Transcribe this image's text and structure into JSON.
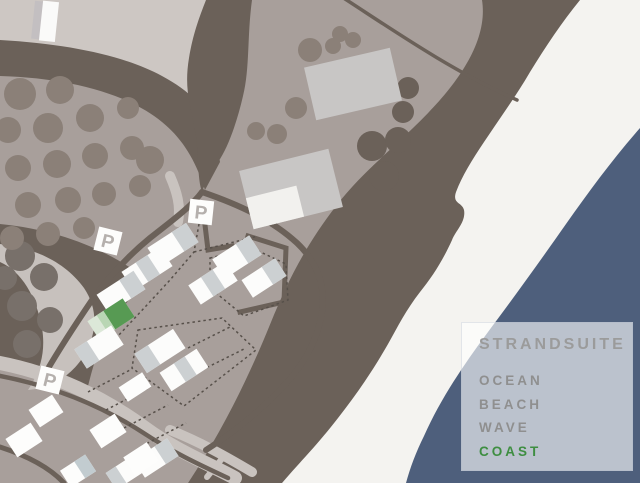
{
  "legend": {
    "title": "STRANDSUITE",
    "items": [
      {
        "label": "OCEAN",
        "color": "#8f8f8f"
      },
      {
        "label": "BEACH",
        "color": "#8f8f8f"
      },
      {
        "label": "WAVE",
        "color": "#8f8f8f"
      },
      {
        "label": "COAST",
        "color": "#3e8e41"
      }
    ]
  },
  "map": {
    "parking_label": "P",
    "colors": {
      "land_light": "#cdc7c3",
      "land_mauve": "#a89f9b",
      "terrain_dark": "#6b6159",
      "tree": "#8b8078",
      "tree_on_light": "#78706a",
      "beach": "#f4f3f0",
      "ocean": "#4e5f7c",
      "road_light": "#c9c3bf",
      "building_white": "#fcfcfb",
      "building_gray": "#ccd0d2",
      "building_big_gray": "#c8c6c5",
      "highlight_green_dark": "#579a53",
      "highlight_green_mid": "#b9d6b4",
      "highlight_green_pale": "#dce8d8",
      "parking_letter": "#b5b0ad"
    }
  }
}
